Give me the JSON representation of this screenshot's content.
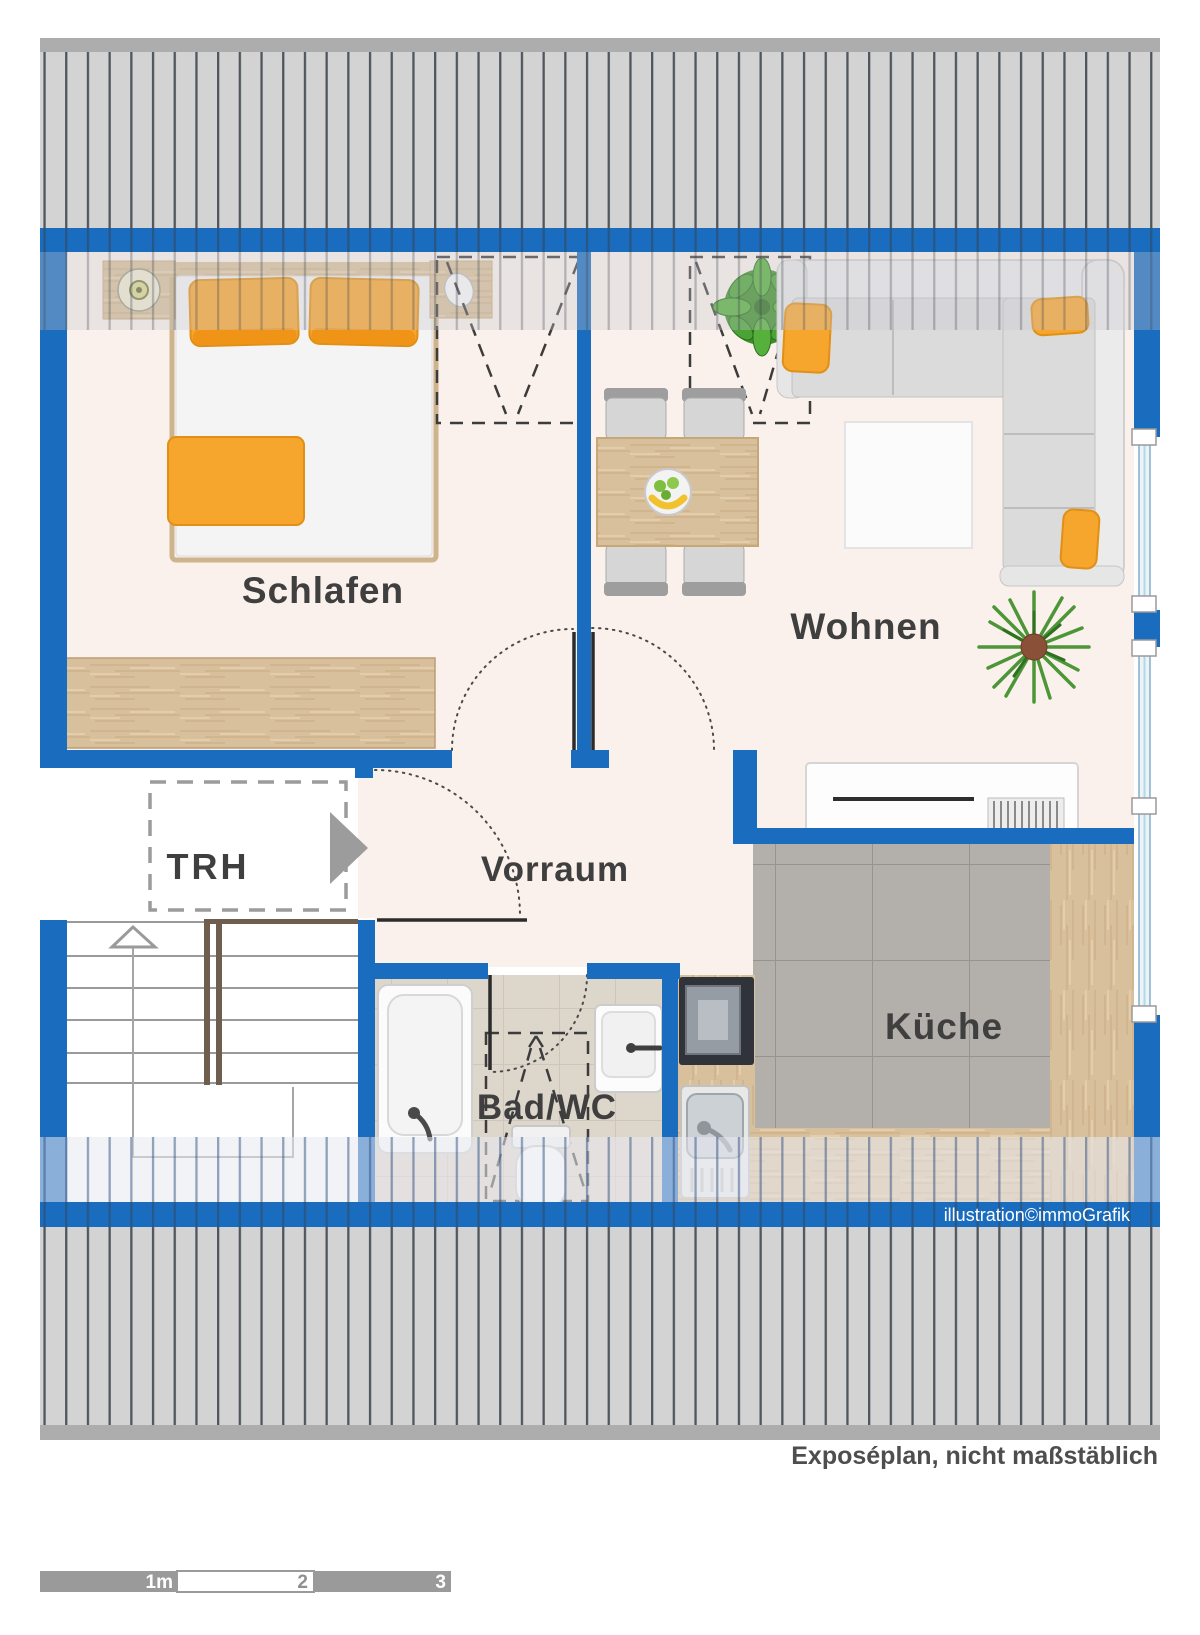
{
  "plan": {
    "rooms": {
      "schlafen": "Schlafen",
      "wohnen": "Wohnen",
      "vorraum": "Vorraum",
      "kueche": "Küche",
      "bad_wc": "Bad/WC",
      "treppenhaus": "TRH"
    },
    "watermark": "illustration©immoGrafik",
    "footer_note": "Exposéplan, nicht maßstäblich",
    "scale_bar": {
      "seg1": "1m",
      "seg2": "2",
      "seg3": "3"
    },
    "colors": {
      "wall_blue": "#1a6cbe",
      "accent_orange": "#f6a52d",
      "roof_gray": "#d3d3d3",
      "floor_cream": "#faf1ec"
    }
  }
}
